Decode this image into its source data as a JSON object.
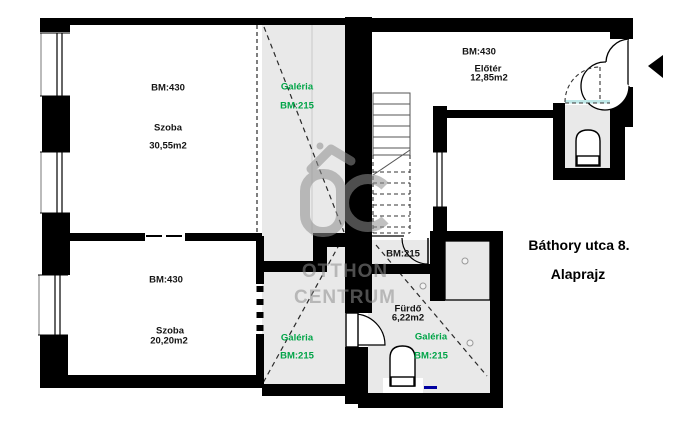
{
  "title": {
    "address": "Báthory utca 8.",
    "subtitle": "Alaprajz"
  },
  "labels": {
    "room1_bm": "BM:430",
    "room1_name": "Szoba",
    "room1_area": "30,55m2",
    "room2_bm": "BM:430",
    "room2_name": "Szoba",
    "room2_area": "20,20m2",
    "galeria_upper_name": "Galéria",
    "galeria_upper_bm": "BM:215",
    "galeria_lower_name": "Galéria",
    "galeria_lower_bm": "BM:215",
    "eloter_bm": "BM:430",
    "eloter_name": "Előtér",
    "eloter_area": "12,85m2",
    "hall_bm": "BM:215",
    "furdo_name": "Fürdő",
    "furdo_area": "6,22m2",
    "bath_galeria_name": "Galéria",
    "bath_galeria_bm": "BM:215"
  },
  "watermark": {
    "line1": "OTTHON",
    "line2": "CENTRUM"
  },
  "colors": {
    "wall": "#000000",
    "floor_gray": "#e9e9e9",
    "accent_green": "#00a447",
    "watermark_gray": "#8f8f8f",
    "threshold_cyan": "#bfe8e8",
    "fixture_blue": "#0000a0"
  }
}
